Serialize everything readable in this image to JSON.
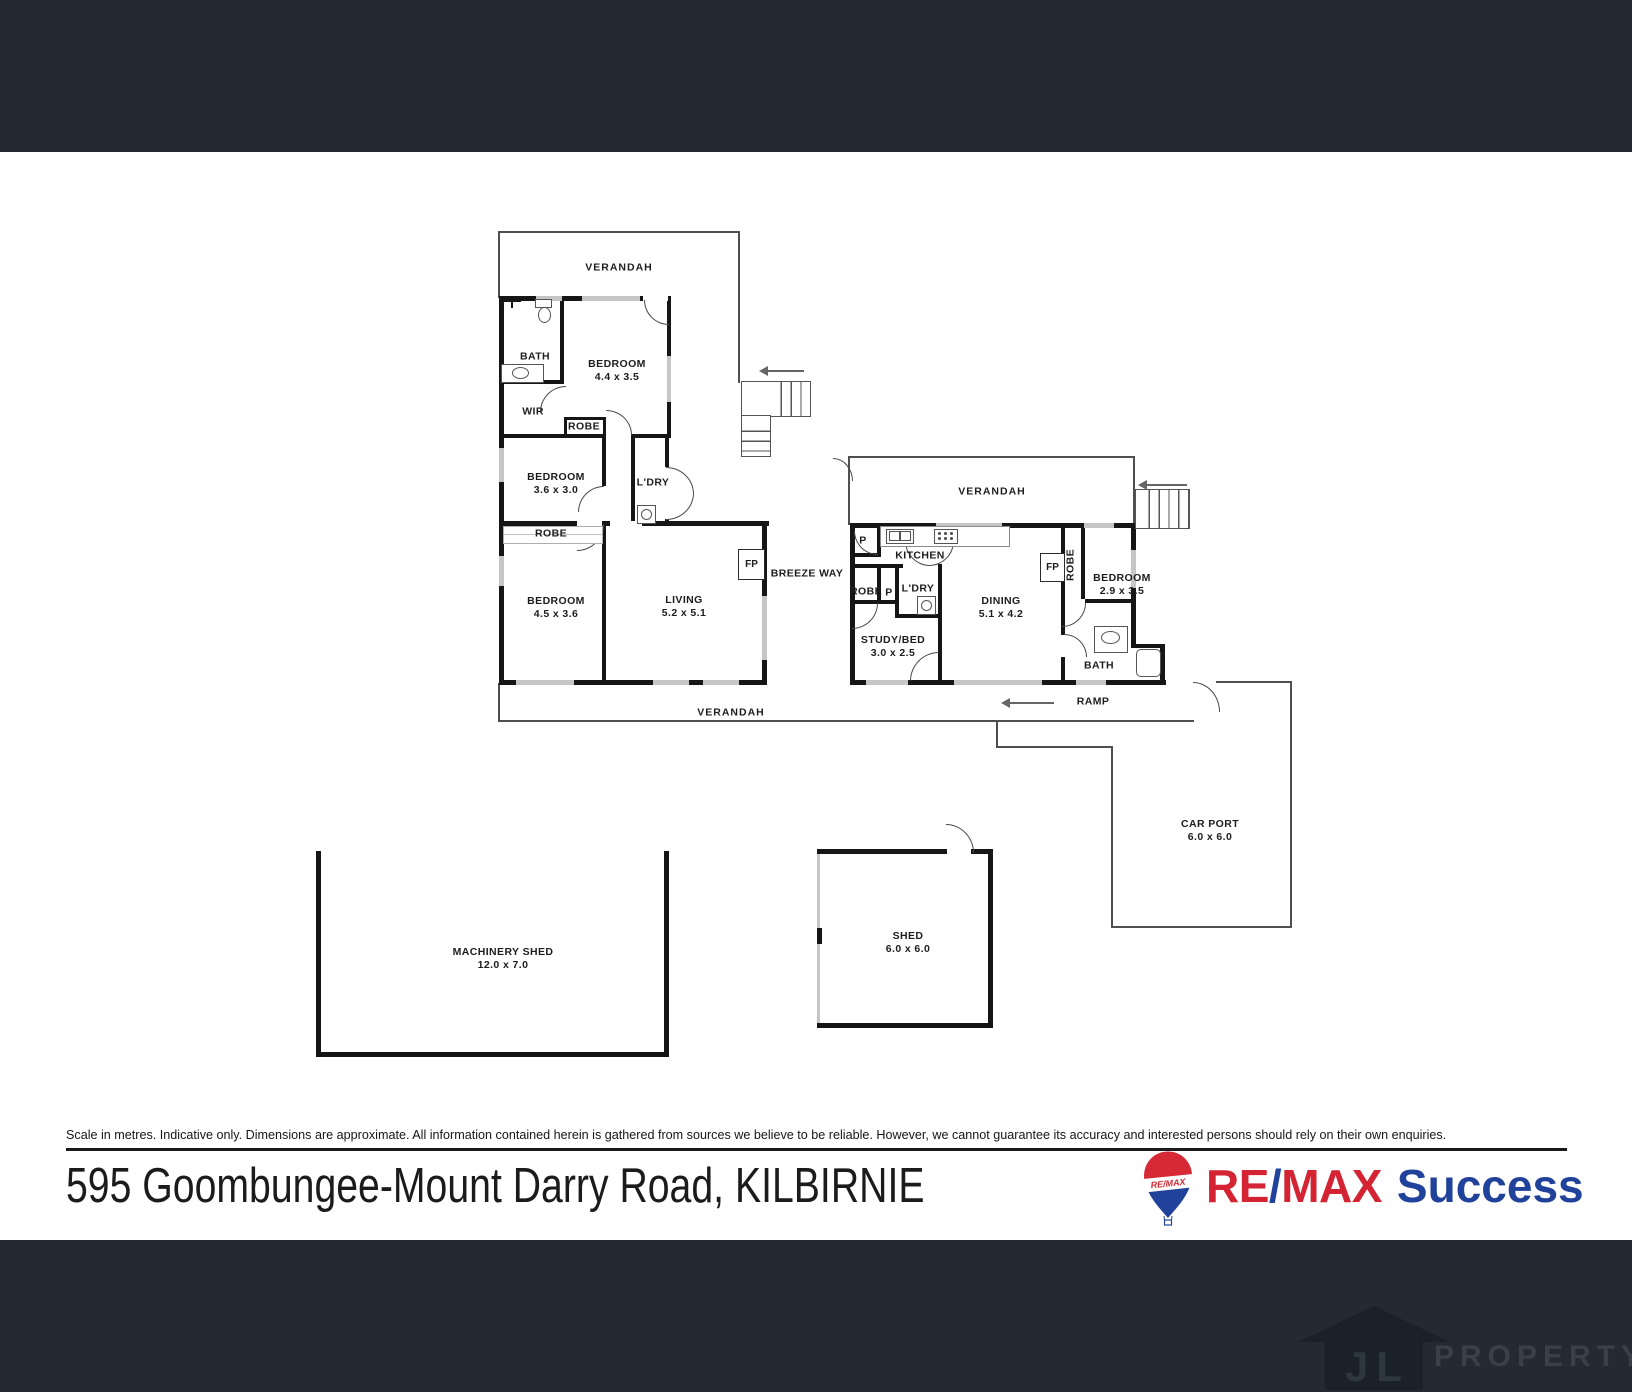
{
  "plan": {
    "labels": {
      "verandah_top": {
        "label": "VERANDAH"
      },
      "bath_left": {
        "label": "BATH"
      },
      "bedroom1": {
        "label": "BEDROOM",
        "dims": "4.4 x 3.5"
      },
      "wir": {
        "label": "WIR"
      },
      "robe1": {
        "label": "ROBE"
      },
      "bedroom2": {
        "label": "BEDROOM",
        "dims": "3.6 x 3.0"
      },
      "laundry_left": {
        "label": "L'DRY"
      },
      "robe2": {
        "label": "ROBE"
      },
      "bedroom3": {
        "label": "BEDROOM",
        "dims": "4.5 x 3.6"
      },
      "living": {
        "label": "LIVING",
        "dims": "5.2 x 5.1"
      },
      "fireplace_left": {
        "label": "FP"
      },
      "breezeway": {
        "label": "BREEZE WAY"
      },
      "verandah_right": {
        "label": "VERANDAH"
      },
      "pantry1": {
        "label": "P"
      },
      "kitchen": {
        "label": "KITCHEN"
      },
      "robe3": {
        "label": "ROBE"
      },
      "pantry2": {
        "label": "P"
      },
      "laundry_right": {
        "label": "L'DRY"
      },
      "study": {
        "label": "STUDY/BED",
        "dims": "3.0 x 2.5"
      },
      "dining": {
        "label": "DINING",
        "dims": "5.1 x 4.2"
      },
      "fireplace_right": {
        "label": "FP"
      },
      "robe4": {
        "label": "ROBE"
      },
      "bedroom4": {
        "label": "BEDROOM",
        "dims": "2.9 x 3.5"
      },
      "bath_right": {
        "label": "BATH"
      },
      "ramp": {
        "label": "RAMP"
      },
      "verandah_bottom": {
        "label": "VERANDAH"
      },
      "carport": {
        "label": "CAR PORT",
        "dims": "6.0 x 6.0"
      },
      "machinery_shed": {
        "label": "MACHINERY SHED",
        "dims": "12.0 x 7.0"
      },
      "shed": {
        "label": "SHED",
        "dims": "6.0 x 6.0"
      }
    }
  },
  "disclaimer": {
    "text": "Scale in metres. Indicative only. Dimensions are approximate. All information contained herein is gathered from sources we believe to be reliable. However, we cannot guarantee its accuracy and interested persons should rely on their own enquiries."
  },
  "footer": {
    "address": "595 Goombungee-Mount Darry Road, KILBIRNIE"
  },
  "brand": {
    "re": "RE",
    "slash": "/",
    "max": "MAX",
    "office": "Success",
    "balloon_text": "RE/MAX",
    "red": "#d42332",
    "blue": "#20429a"
  },
  "watermark": {
    "initials": "JL",
    "text": "PROPERTY"
  }
}
